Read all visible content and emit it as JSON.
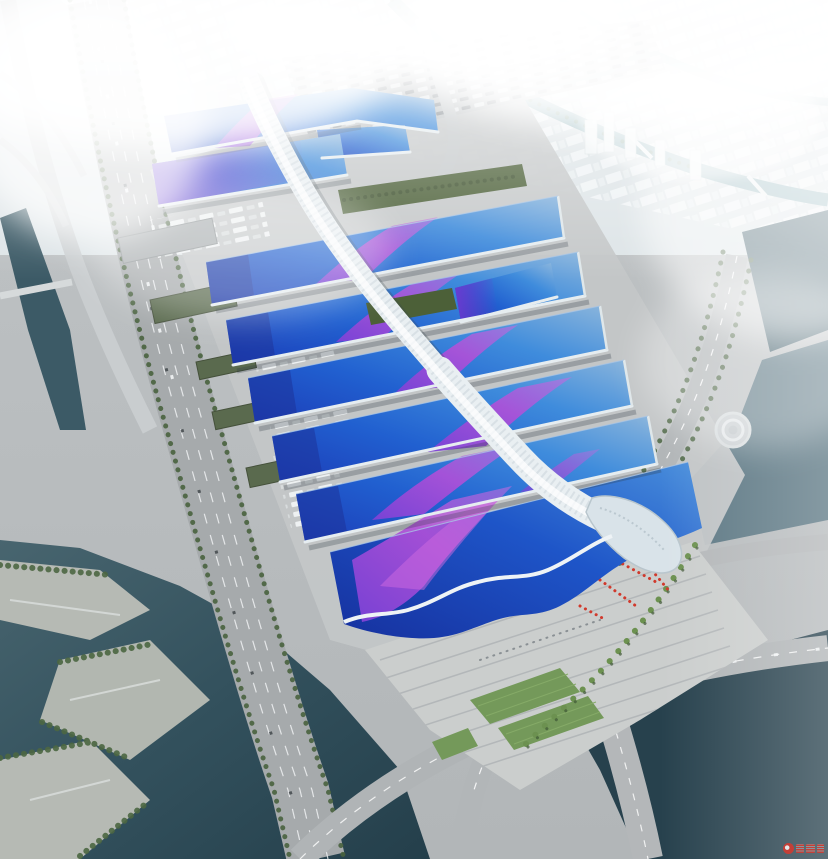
{
  "scene": {
    "title": "Aerial rendering of a riverside exhibition and convention center",
    "description": "Bird's-eye architectural rendering: parallel rows of wave-shaped exhibition halls with blue gradient roofs and sweeping purple ribbon graphics, linked by a white diamond-gridshell serpentine concourse that ends in a silver shell above the south entrance hall; arrival plaza with red flags and palm-lined boulevard, truck yards and parking lots, a multi-lane highway and dark canals on the west and south, a spiral pavilion by the east river, and a hazy white city skyline with a winding teal canal to the north. Small red watermark logo in the bottom-right corner.",
    "landmarks": [
      "hazy city skyline",
      "winding canal",
      "exhibition hall roofs",
      "purple roof ribbons",
      "central concourse spine",
      "rooftop gardens",
      "south entrance shell",
      "arrival plaza",
      "red flag cluster",
      "palm-lined boulevard",
      "riverside park",
      "west highway",
      "north parking lot",
      "truck yards",
      "warehouses",
      "spiral pavilion",
      "east river",
      "pedestrian bridges",
      "watermark logo"
    ]
  },
  "palette": {
    "ground": "#b7bbbd",
    "apron": "#c3c6c7",
    "plaza": "#cbcecd",
    "road": "#a9adaf",
    "roof_blue_deep": "#1b3fbe",
    "roof_blue": "#2563d6",
    "roof_blue_light": "#57a0de",
    "ribbon_purple": "#7d42d6",
    "ribbon_magenta": "#c155d8",
    "spine_white": "#e9eff2",
    "green_dark": "#4c6038",
    "green": "#5d7c4a",
    "lawn": "#74995a",
    "water": "#3c5a66",
    "water_dark": "#27414d",
    "city_haze": "#e3e9ec",
    "fog": "#ffffff",
    "flag_red": "#d0392c",
    "watermark_red": "#d8392e"
  },
  "watermark": {
    "description": "small red logo watermark, illegible",
    "color": "#d8392e"
  }
}
